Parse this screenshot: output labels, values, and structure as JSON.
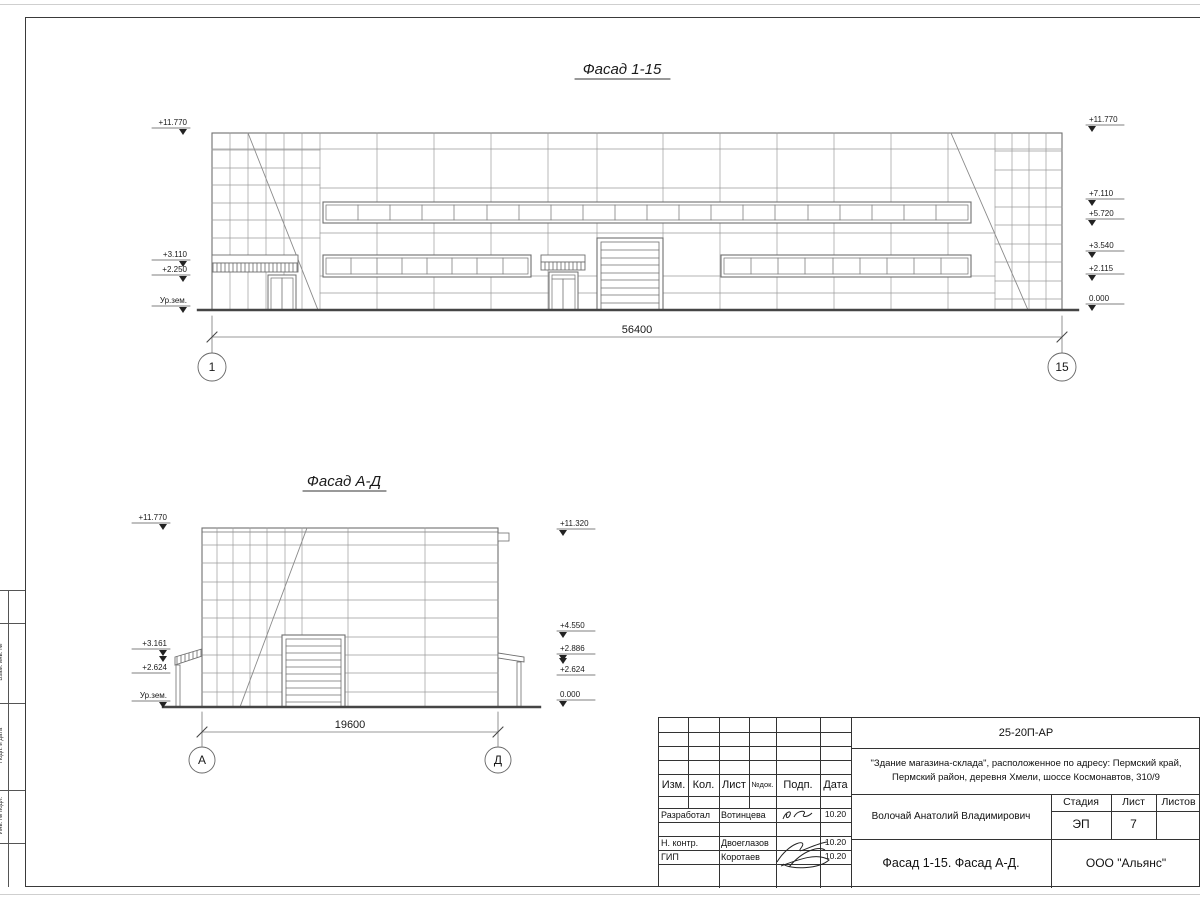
{
  "colors": {
    "line": "#7a7a7a",
    "dark": "#3a3a3a",
    "text": "#1a1a1a"
  },
  "facade_1_15": {
    "title": "Фасад 1-15",
    "marks_left": [
      "+11.770",
      "+3.110",
      "+2.250",
      "Ур.зем."
    ],
    "marks_right": [
      "+11.770",
      "+7.110",
      "+5.720",
      "+3.540",
      "+2.115",
      "0.000"
    ],
    "dimension": "56400",
    "axes": [
      "1",
      "15"
    ]
  },
  "facade_ad": {
    "title": "Фасад А-Д",
    "marks_left": [
      "+11.770",
      "+3.161",
      "+2.624",
      "Ур.зем."
    ],
    "marks_right": [
      "+11.320",
      "+4.550",
      "+2.886",
      "+2.624",
      "0.000"
    ],
    "dimension": "19600",
    "axes": [
      "А",
      "Д"
    ]
  },
  "side_strip": [
    "Взам. инв. №",
    "Подп. и дата",
    "Инв. № подл."
  ],
  "title_block": {
    "code": "25-20П-АР",
    "object_line1": "\"Здание магазина-склада\", расположенное по адресу: Пермский край,",
    "object_line2": "Пермский район, деревня Хмели, шоссе Космонавтов, 310/9",
    "header": {
      "izm": "Изм.",
      "kol": "Кол.",
      "list": "Лист",
      "ndok": "№док.",
      "podp": "Подп.",
      "data": "Дата"
    },
    "rows": [
      {
        "role": "Разработал",
        "name": "Вотинцева",
        "date": "10.20"
      },
      {
        "role": "Н. контр.",
        "name": "Двоеглазов",
        "date": "10.20"
      },
      {
        "role": "ГИП",
        "name": "Коротаев",
        "date": "10.20"
      }
    ],
    "designer": "Волочай Анатолий Владимирович",
    "stage_header": [
      "Стадия",
      "Лист",
      "Листов"
    ],
    "stage": "ЭП",
    "sheet_no": "7",
    "sheets_total": "",
    "doc_title": "Фасад 1-15. Фасад А-Д.",
    "company": "ООО \"Альянс\""
  }
}
